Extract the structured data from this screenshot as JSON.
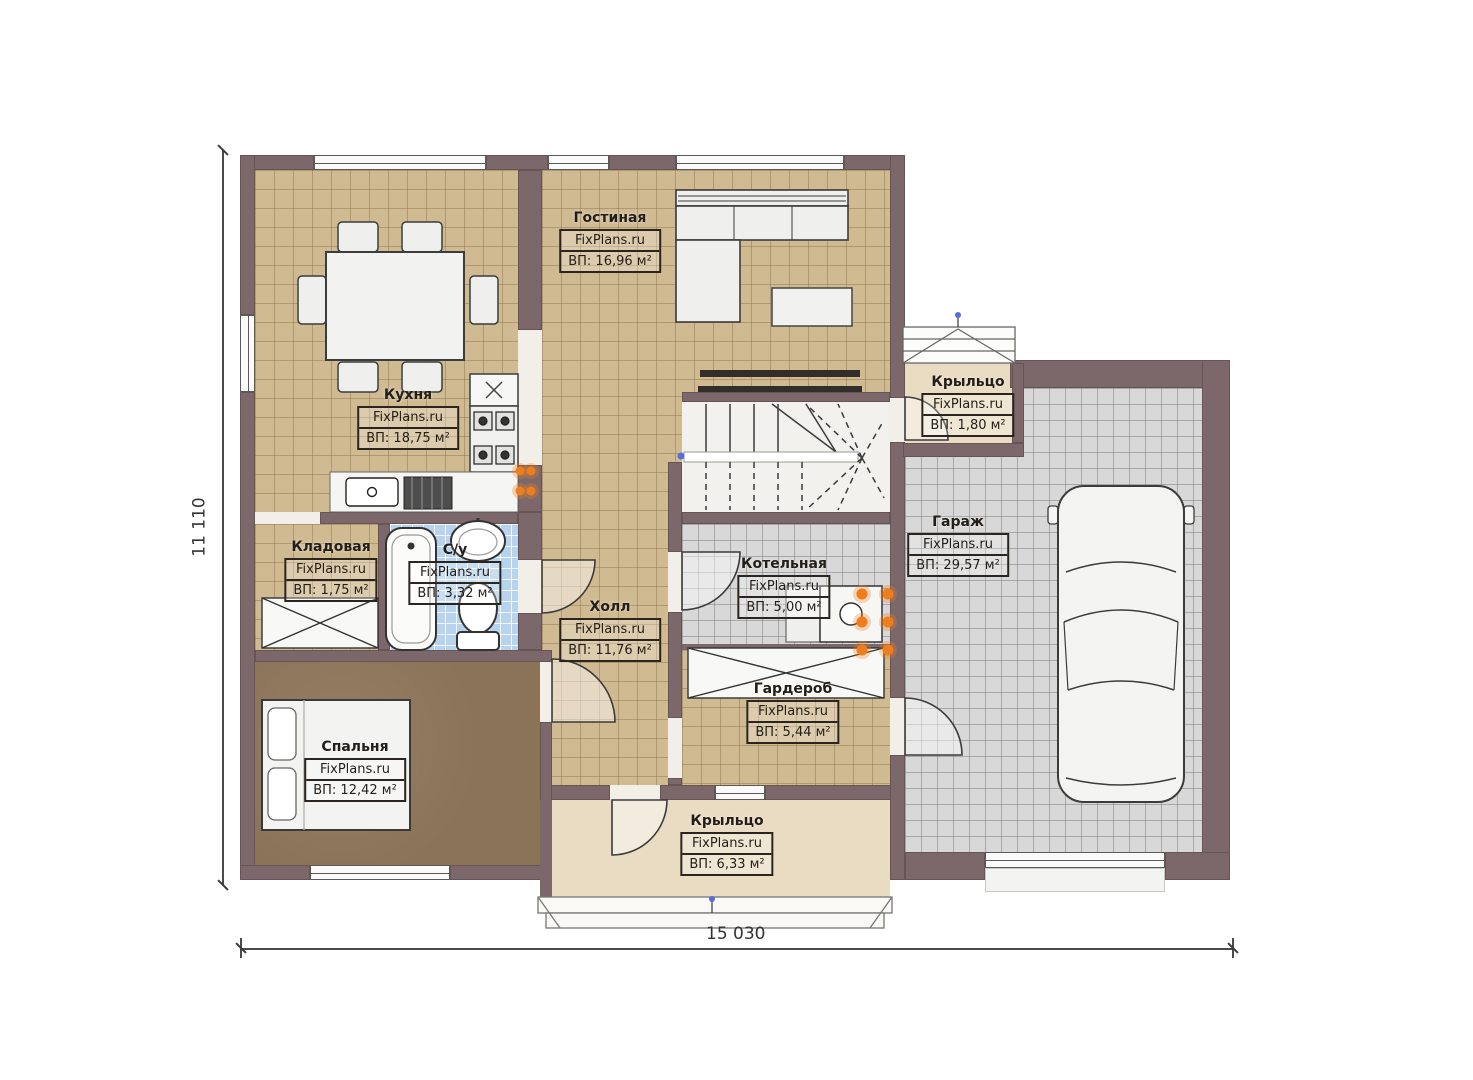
{
  "watermark": "FixPlans.ru",
  "dimensions": {
    "width": "15 030",
    "height": "11 110"
  },
  "rooms": [
    {
      "id": "living",
      "name": "Гостиная",
      "watermark": "FixPlans.ru",
      "area": "ВП: 16,96 м²"
    },
    {
      "id": "kitchen",
      "name": "Кухня",
      "watermark": "FixPlans.ru",
      "area": "ВП: 18,75 м²"
    },
    {
      "id": "storage",
      "name": "Кладовая",
      "watermark": "FixPlans.ru",
      "area": "ВП: 1,75 м²"
    },
    {
      "id": "bathroom",
      "name": "С/у",
      "watermark": "FixPlans.ru",
      "area": "ВП: 3,32 м²"
    },
    {
      "id": "hall",
      "name": "Холл",
      "watermark": "FixPlans.ru",
      "area": "ВП: 11,76 м²"
    },
    {
      "id": "boiler",
      "name": "Котельная",
      "watermark": "FixPlans.ru",
      "area": "ВП: 5,00 м²"
    },
    {
      "id": "wardrobe",
      "name": "Гардероб",
      "watermark": "FixPlans.ru",
      "area": "ВП: 5,44 м²"
    },
    {
      "id": "bedroom",
      "name": "Спальня",
      "watermark": "FixPlans.ru",
      "area": "ВП: 12,42 м²"
    },
    {
      "id": "garage",
      "name": "Гараж",
      "watermark": "FixPlans.ru",
      "area": "ВП: 29,57 м²"
    },
    {
      "id": "porch-top",
      "name": "Крыльцо",
      "watermark": "FixPlans.ru",
      "area": "ВП: 1,80 м²"
    },
    {
      "id": "porch-bottom",
      "name": "Крыльцо",
      "watermark": "FixPlans.ru",
      "area": "ВП: 6,33 м²"
    }
  ],
  "colors": {
    "wall": "#7c686a",
    "floor_tan": "#d0ba92",
    "floor_gray": "#d8d8d8",
    "floor_blue": "#b7d3ed",
    "floor_bedroom": "#8b7357",
    "porch": "#e9dcc3",
    "radiator": "#ee7d1e"
  }
}
